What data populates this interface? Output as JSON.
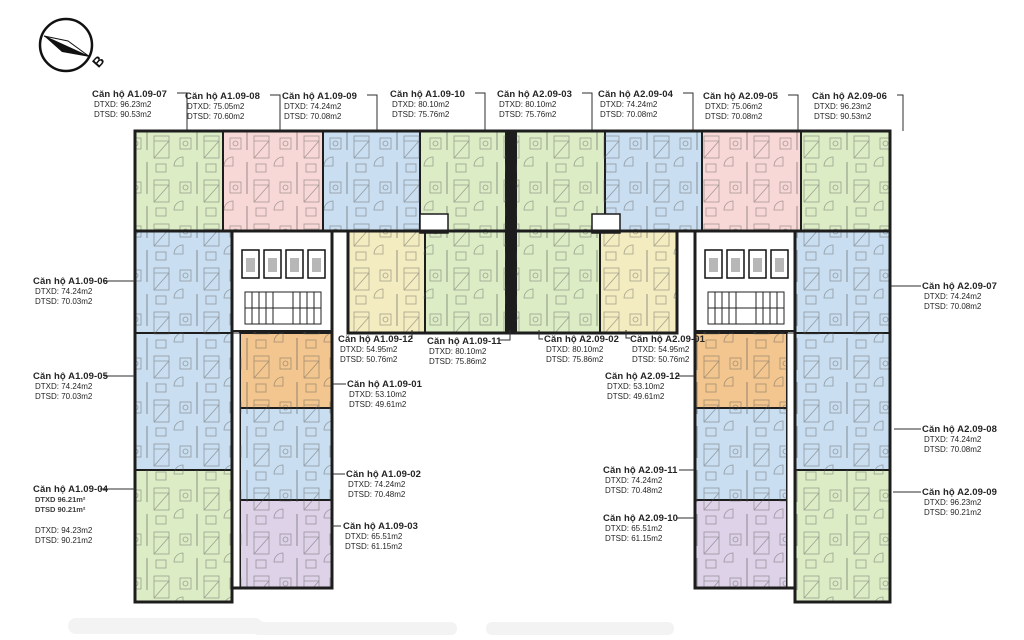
{
  "palette": {
    "green": "#dcedc6",
    "pink": "#f8d8d6",
    "blue": "#c9def0",
    "yellow": "#f3ecc0",
    "orange": "#f2c68e",
    "purple": "#ddd2e8",
    "wall": "#1d1d1d",
    "leader": "#2e2e2e",
    "label_text": "#252525"
  },
  "compass": {
    "north_label": "B"
  },
  "units": {
    "a1_09_07": {
      "name": "Căn hộ A1.09-07",
      "dtxd": "DTXD: 96.23m2",
      "dtsd": "DTSD: 90.53m2"
    },
    "a1_09_08": {
      "name": "Căn hộ A1.09-08",
      "dtxd": "DTXD: 75.05m2",
      "dtsd": "DTSD: 70.60m2"
    },
    "a1_09_09": {
      "name": "Căn hộ A1.09-09",
      "dtxd": "DTXD: 74.24m2",
      "dtsd": "DTSD: 70.08m2"
    },
    "a1_09_10": {
      "name": "Căn hộ A1.09-10",
      "dtxd": "DTXD: 80.10m2",
      "dtsd": "DTSD: 75.76m2"
    },
    "a2_09_03": {
      "name": "Căn hộ A2.09-03",
      "dtxd": "DTXD: 80.10m2",
      "dtsd": "DTSD: 75.76m2"
    },
    "a2_09_04": {
      "name": "Căn hộ A2.09-04",
      "dtxd": "DTXD: 74.24m2",
      "dtsd": "DTSD: 70.08m2"
    },
    "a2_09_05": {
      "name": "Căn hộ A2.09-05",
      "dtxd": "DTXD: 75.06m2",
      "dtsd": "DTSD: 70.08m2"
    },
    "a2_09_06": {
      "name": "Căn hộ A2.09-06",
      "dtxd": "DTXD: 96.23m2",
      "dtsd": "DTSD: 90.53m2"
    },
    "a1_09_06": {
      "name": "Căn hộ A1.09-06",
      "dtxd": "DTXD: 74.24m2",
      "dtsd": "DTSD: 70.03m2"
    },
    "a1_09_05": {
      "name": "Căn hộ A1.09-05",
      "dtxd": "DTXD: 74.24m2",
      "dtsd": "DTSD: 70.03m2"
    },
    "a1_09_04": {
      "name": "Căn hộ A1.09-04",
      "dtxd_ghost": "DTXD 96.21m²",
      "dtsd_ghost": "DTSD 90.21m²",
      "dtxd": "DTXD: 94.23m2",
      "dtsd": "DTSD: 90.21m2"
    },
    "a1_09_12": {
      "name": "Căn hộ A1.09-12",
      "dtxd": "DTXD: 54.95m2",
      "dtsd": "DTSD: 50.76m2"
    },
    "a1_09_11": {
      "name": "Căn hộ A1.09-11",
      "dtxd": "DTXD: 80.10m2",
      "dtsd": "DTSD: 75.86m2"
    },
    "a2_09_02": {
      "name": "Căn hộ A2.09-02",
      "dtxd": "DTXD: 80.10m2",
      "dtsd": "DTSD: 75.86m2"
    },
    "a2_09_01": {
      "name": "Căn hộ A2.09-01",
      "dtxd": "DTXD: 54.95m2",
      "dtsd": "DTSD: 50.76m2"
    },
    "a2_09_12": {
      "name": "Căn hộ A2.09-12",
      "dtxd": "DTXD: 53.10m2",
      "dtsd": "DTSD: 49.61m2"
    },
    "a1_09_01": {
      "name": "Căn hộ A1.09-01",
      "dtxd": "DTXD: 53.10m2",
      "dtsd": "DTSD: 49.61m2"
    },
    "a1_09_02": {
      "name": "Căn hộ A1.09-02",
      "dtxd": "DTXD: 74.24m2",
      "dtsd": "DTSD: 70.48m2"
    },
    "a1_09_03": {
      "name": "Căn hộ A1.09-03",
      "dtxd": "DTXD: 65.51m2",
      "dtsd": "DTSD: 61.15m2"
    },
    "a2_09_07": {
      "name": "Căn hộ A2.09-07",
      "dtxd": "DTXD: 74.24m2",
      "dtsd": "DTSD: 70.08m2"
    },
    "a2_09_08": {
      "name": "Căn hộ A2.09-08",
      "dtxd": "DTXD: 74.24m2",
      "dtsd": "DTSD: 70.08m2"
    },
    "a2_09_09": {
      "name": "Căn hộ A2.09-09",
      "dtxd": "DTXD: 96.23m2",
      "dtsd": "DTSD: 90.21m2"
    },
    "a2_09_11": {
      "name": "Căn hộ A2.09-11",
      "dtxd": "DTXD: 74.24m2",
      "dtsd": "DTSD: 70.48m2"
    },
    "a2_09_10": {
      "name": "Căn hộ A2.09-10",
      "dtxd": "DTXD: 65.51m2",
      "dtsd": "DTSD: 61.15m2"
    }
  }
}
